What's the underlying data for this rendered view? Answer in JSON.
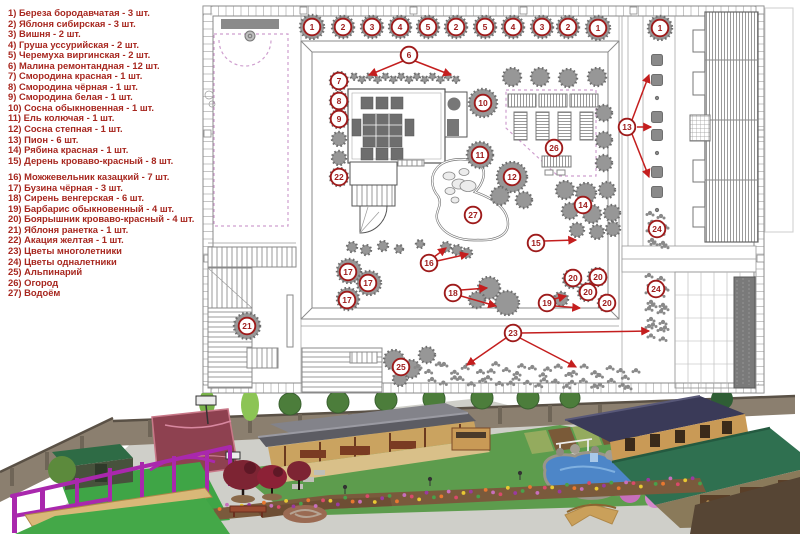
{
  "legend": {
    "title": "plant-legend",
    "text_color": "#a7271f",
    "group_break_after": 15,
    "items": [
      "1) Береза бородавчатая - 3 шт.",
      "2) Яблоня сибирская - 3 шт.",
      "3) Вишня - 2 шт.",
      "4) Груша уссурийская - 2 шт.",
      "5) Черемуха виргинская - 2 шт.",
      "6) Малина ремонтандная - 12 шт.",
      "7) Смородина красная - 1 шт.",
      "8) Смородина чёрная - 1 шт.",
      "9) Смородина белая - 1 шт.",
      "10) Сосна обыкновенная - 1 шт.",
      "11) Ель колючая - 1 шт.",
      "12) Сосна степная - 1 шт.",
      "13) Пион - 6 шт.",
      "14) Рябина красная - 1 шт.",
      "15) Дерень кроваво-красный - 8 шт.",
      "16) Можжевельник казацкий - 7 шт.",
      "17) Бузина чёрная - 3 шт.",
      "18) Сирень венгерская - 6 шт.",
      "19) Барбарис обыкновенный - 4 шт.",
      "20) Боярышник кроваво-красный - 4 шт.",
      "21) Яблоня ранетка - 1 шт.",
      "22) Акация желтая - 1 шт.",
      "23) Цветы многолетники",
      "24) Цветы одналетники",
      "25) Альпинарий",
      "26) Огород",
      "27) Водоём"
    ]
  },
  "plan": {
    "colors": {
      "marker": "#9e1b1b",
      "arrow": "#c41e1e",
      "lines": "#8a8a8a",
      "plants": "#979797",
      "boundary_dash": "#cf9fcf"
    },
    "markers": [
      {
        "n": 1,
        "x": 312,
        "y": 27
      },
      {
        "n": 2,
        "x": 343,
        "y": 27
      },
      {
        "n": 3,
        "x": 372,
        "y": 27
      },
      {
        "n": 4,
        "x": 400,
        "y": 27
      },
      {
        "n": 5,
        "x": 428,
        "y": 27
      },
      {
        "n": 2,
        "x": 456,
        "y": 27
      },
      {
        "n": 5,
        "x": 485,
        "y": 27
      },
      {
        "n": 4,
        "x": 513,
        "y": 27
      },
      {
        "n": 3,
        "x": 542,
        "y": 27
      },
      {
        "n": 2,
        "x": 568,
        "y": 27
      },
      {
        "n": 1,
        "x": 598,
        "y": 28
      },
      {
        "n": 1,
        "x": 660,
        "y": 28
      },
      {
        "n": 6,
        "x": 409,
        "y": 55
      },
      {
        "n": 7,
        "x": 339,
        "y": 81
      },
      {
        "n": 8,
        "x": 339,
        "y": 101
      },
      {
        "n": 9,
        "x": 339,
        "y": 119
      },
      {
        "n": 10,
        "x": 483,
        "y": 103
      },
      {
        "n": 11,
        "x": 480,
        "y": 155
      },
      {
        "n": 12,
        "x": 512,
        "y": 177
      },
      {
        "n": 13,
        "x": 627,
        "y": 127
      },
      {
        "n": 14,
        "x": 583,
        "y": 205
      },
      {
        "n": 15,
        "x": 536,
        "y": 243
      },
      {
        "n": 16,
        "x": 429,
        "y": 263
      },
      {
        "n": 17,
        "x": 348,
        "y": 272
      },
      {
        "n": 17,
        "x": 368,
        "y": 283
      },
      {
        "n": 17,
        "x": 347,
        "y": 300
      },
      {
        "n": 18,
        "x": 453,
        "y": 293
      },
      {
        "n": 19,
        "x": 547,
        "y": 303
      },
      {
        "n": 20,
        "x": 573,
        "y": 278
      },
      {
        "n": 20,
        "x": 598,
        "y": 277
      },
      {
        "n": 20,
        "x": 588,
        "y": 292
      },
      {
        "n": 20,
        "x": 607,
        "y": 303
      },
      {
        "n": 21,
        "x": 247,
        "y": 326
      },
      {
        "n": 22,
        "x": 339,
        "y": 177
      },
      {
        "n": 23,
        "x": 513,
        "y": 333
      },
      {
        "n": 24,
        "x": 657,
        "y": 229
      },
      {
        "n": 24,
        "x": 656,
        "y": 289
      },
      {
        "n": 25,
        "x": 401,
        "y": 367
      },
      {
        "n": 26,
        "x": 554,
        "y": 148
      },
      {
        "n": 27,
        "x": 473,
        "y": 215
      }
    ],
    "arrows": [
      [
        403,
        61,
        369,
        75
      ],
      [
        415,
        61,
        451,
        75
      ],
      [
        632,
        120,
        649,
        75
      ],
      [
        637,
        127,
        651,
        127
      ],
      [
        632,
        134,
        649,
        177
      ],
      [
        544,
        241,
        576,
        240
      ],
      [
        434,
        257,
        446,
        248
      ],
      [
        437,
        261,
        468,
        254
      ],
      [
        461,
        290,
        487,
        288
      ],
      [
        461,
        296,
        496,
        306
      ],
      [
        554,
        299,
        566,
        296
      ],
      [
        555,
        306,
        580,
        308
      ],
      [
        506,
        338,
        467,
        365
      ],
      [
        520,
        338,
        576,
        367
      ],
      [
        521,
        333,
        649,
        331
      ]
    ],
    "trees": [
      [
        312,
        27,
        12
      ],
      [
        343,
        27,
        11
      ],
      [
        372,
        27,
        11
      ],
      [
        400,
        27,
        11
      ],
      [
        428,
        27,
        11
      ],
      [
        456,
        27,
        11
      ],
      [
        485,
        27,
        11
      ],
      [
        513,
        27,
        11
      ],
      [
        542,
        27,
        11
      ],
      [
        568,
        27,
        11
      ],
      [
        598,
        28,
        12
      ],
      [
        660,
        28,
        12
      ],
      [
        339,
        81,
        9
      ],
      [
        339,
        101,
        9
      ],
      [
        339,
        119,
        9
      ],
      [
        339,
        139,
        7
      ],
      [
        339,
        158,
        7
      ],
      [
        339,
        177,
        9
      ],
      [
        512,
        77,
        9
      ],
      [
        540,
        77,
        9
      ],
      [
        568,
        78,
        9
      ],
      [
        597,
        77,
        9
      ],
      [
        604,
        113,
        8
      ],
      [
        604,
        140,
        8
      ],
      [
        604,
        163,
        8
      ],
      [
        483,
        103,
        14
      ],
      [
        480,
        155,
        13
      ],
      [
        512,
        177,
        15
      ],
      [
        500,
        196,
        9
      ],
      [
        524,
        200,
        8
      ],
      [
        565,
        190,
        9
      ],
      [
        586,
        193,
        10
      ],
      [
        607,
        190,
        8
      ],
      [
        570,
        211,
        8
      ],
      [
        592,
        214,
        9
      ],
      [
        612,
        213,
        8
      ],
      [
        577,
        230,
        7
      ],
      [
        597,
        232,
        7
      ],
      [
        613,
        229,
        7
      ],
      [
        349,
        271,
        12
      ],
      [
        369,
        283,
        12
      ],
      [
        348,
        299,
        11
      ],
      [
        247,
        326,
        13
      ],
      [
        489,
        288,
        11
      ],
      [
        507,
        303,
        12
      ],
      [
        477,
        300,
        8
      ],
      [
        572,
        279,
        9
      ],
      [
        597,
        277,
        9
      ],
      [
        587,
        292,
        9
      ],
      [
        606,
        303,
        8
      ],
      [
        561,
        299,
        7
      ],
      [
        446,
        247,
        5
      ],
      [
        457,
        250,
        5
      ],
      [
        467,
        253,
        5
      ],
      [
        352,
        247,
        5
      ],
      [
        366,
        250,
        5
      ],
      [
        383,
        246,
        5
      ],
      [
        399,
        249,
        4
      ],
      [
        420,
        244,
        4
      ],
      [
        394,
        360,
        10
      ],
      [
        411,
        369,
        9
      ],
      [
        400,
        379,
        7
      ],
      [
        427,
        355,
        8
      ]
    ],
    "raspberry_row": {
      "x1": 354,
      "x2": 456,
      "y": 78,
      "n": 14
    },
    "peony_squares": [
      [
        657,
        60
      ],
      [
        657,
        80
      ],
      [
        657,
        117
      ],
      [
        657,
        135
      ],
      [
        657,
        172
      ],
      [
        657,
        192
      ]
    ],
    "peony_dots": [
      [
        657,
        98
      ],
      [
        657,
        153
      ],
      [
        657,
        210
      ]
    ],
    "flower_bands": [
      {
        "x1": 420,
        "y1": 366,
        "x2": 636,
        "y2": 372,
        "n": 26,
        "w": 5
      },
      {
        "x1": 434,
        "y1": 379,
        "x2": 630,
        "y2": 384,
        "n": 22,
        "w": 3.5
      },
      {
        "x1": 652,
        "y1": 213,
        "x2": 652,
        "y2": 243,
        "n": 6,
        "w": 3
      },
      {
        "x1": 663,
        "y1": 216,
        "x2": 663,
        "y2": 246,
        "n": 6,
        "w": 3
      },
      {
        "x1": 651,
        "y1": 275,
        "x2": 651,
        "y2": 335,
        "n": 11,
        "w": 3
      },
      {
        "x1": 663,
        "y1": 278,
        "x2": 663,
        "y2": 338,
        "n": 11,
        "w": 3
      }
    ]
  },
  "render_3d": {
    "description": "isometric-garden-render",
    "colors": {
      "lawn": "#5d9c4d",
      "paving": "#cfcfc9",
      "court": "#8e4150",
      "playground": "#a928ad",
      "pond": "#4d86c8",
      "roof_gray": "#5c5c63",
      "wood": "#c99a56",
      "roof_navy": "#3a3a58",
      "roof_green": "#2f7050",
      "wall": "#8b7f6f",
      "red_tree": "#7d2433",
      "pink_shrub": "#c76fbc",
      "bright_green": "#3fa546",
      "soil": "#7a5a3c"
    }
  }
}
